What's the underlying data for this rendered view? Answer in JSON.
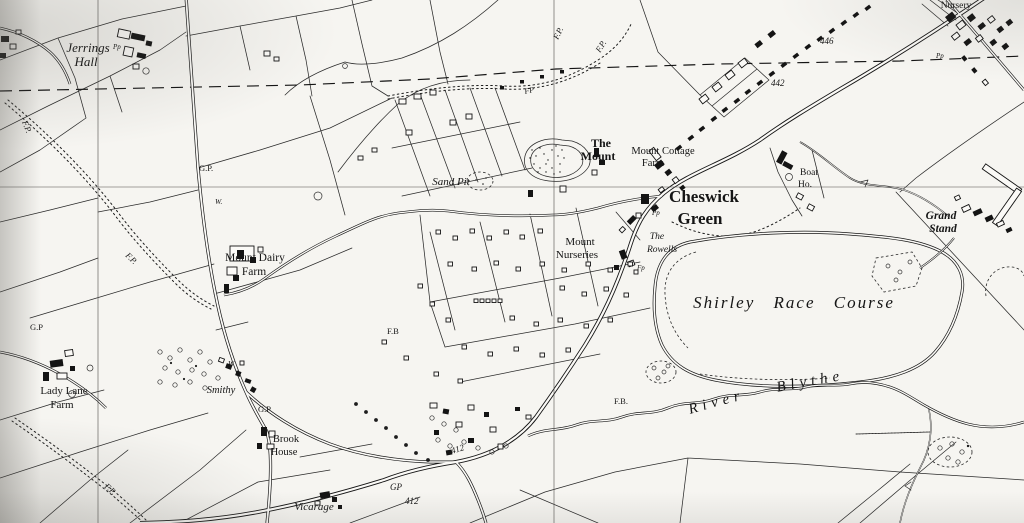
{
  "map": {
    "colors": {
      "paper": "#f6f5f1",
      "ink": "#151515"
    },
    "labels": {
      "jerrings_hall_line1": "Jerrings",
      "jerrings_hall_line2": "Hall",
      "sand_pit": "Sand Pit",
      "the_mount_line1": "The",
      "the_mount_line2": "Mount",
      "mount_cottage_farm_line1": "Mount Cottage",
      "mount_cottage_farm_line2": "Farm",
      "cheswick_green_line1": "Cheswick",
      "cheswick_green_line2": "Green",
      "boat_ho_line1": "Boat",
      "boat_ho_line2": "Ho.",
      "grand_stand_line1": "Grand",
      "grand_stand_line2": "Stand",
      "nursery": "Nursery",
      "mount_dairy_farm_line1": "Mount Dairy",
      "mount_dairy_farm_line2": "Farm",
      "mount_nurseries_line1": "Mount",
      "mount_nurseries_line2": "Nurseries",
      "the_rowells_line1": "The",
      "the_rowells_line2": "Rowells",
      "shirley_race_course": "Shirley Race Course",
      "river_blythe": "River Blythe",
      "lady_lane_farm_line1": "Lady Lane",
      "lady_lane_farm_line2": "Farm",
      "smithy": "Smithy",
      "brook_house_line1": "Brook",
      "brook_house_line2": "House",
      "vicarage": "Vicarage",
      "spot_height_446": "446",
      "spot_height_442": "442",
      "spot_height_412": "412",
      "gp": "G.P.",
      "gp_short": "G.P",
      "gp_bare": "GP",
      "fp": "F.P.",
      "fp_short": "FP",
      "fb": "F.B.",
      "fb_short": "F.B",
      "well": "W.",
      "well_bare": "W",
      "pp": "Pp",
      "fp_lower": "Fp"
    }
  }
}
